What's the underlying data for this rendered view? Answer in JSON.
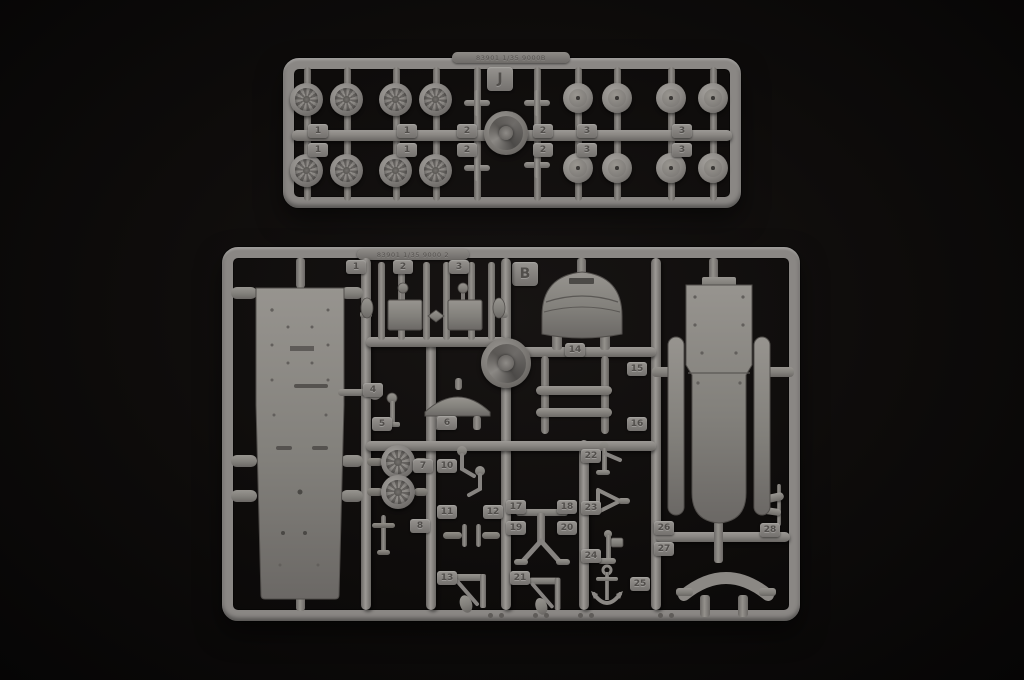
{
  "scene": {
    "description": "Photograph of two gray injection-molded plastic model kit sprues on a black background",
    "background_color": "#0c0a09",
    "plastic_color": "#8b8885"
  },
  "sprueJ": {
    "letter": "J",
    "mold_text": "83901 1/35 9000B",
    "tab_columns": [
      "1",
      "1",
      "2",
      "2",
      "3",
      "3"
    ]
  },
  "sprueB": {
    "letter": "B",
    "mold_text": "83901 1/35 9000 2",
    "top_tabs": [
      "1",
      "2",
      "3"
    ],
    "part_tabs": [
      "4",
      "5",
      "6",
      "7",
      "8",
      "10",
      "11",
      "12",
      "13",
      "14",
      "15",
      "16",
      "17",
      "18",
      "19",
      "20",
      "21",
      "22",
      "23",
      "24",
      "25",
      "26",
      "27",
      "28"
    ]
  }
}
